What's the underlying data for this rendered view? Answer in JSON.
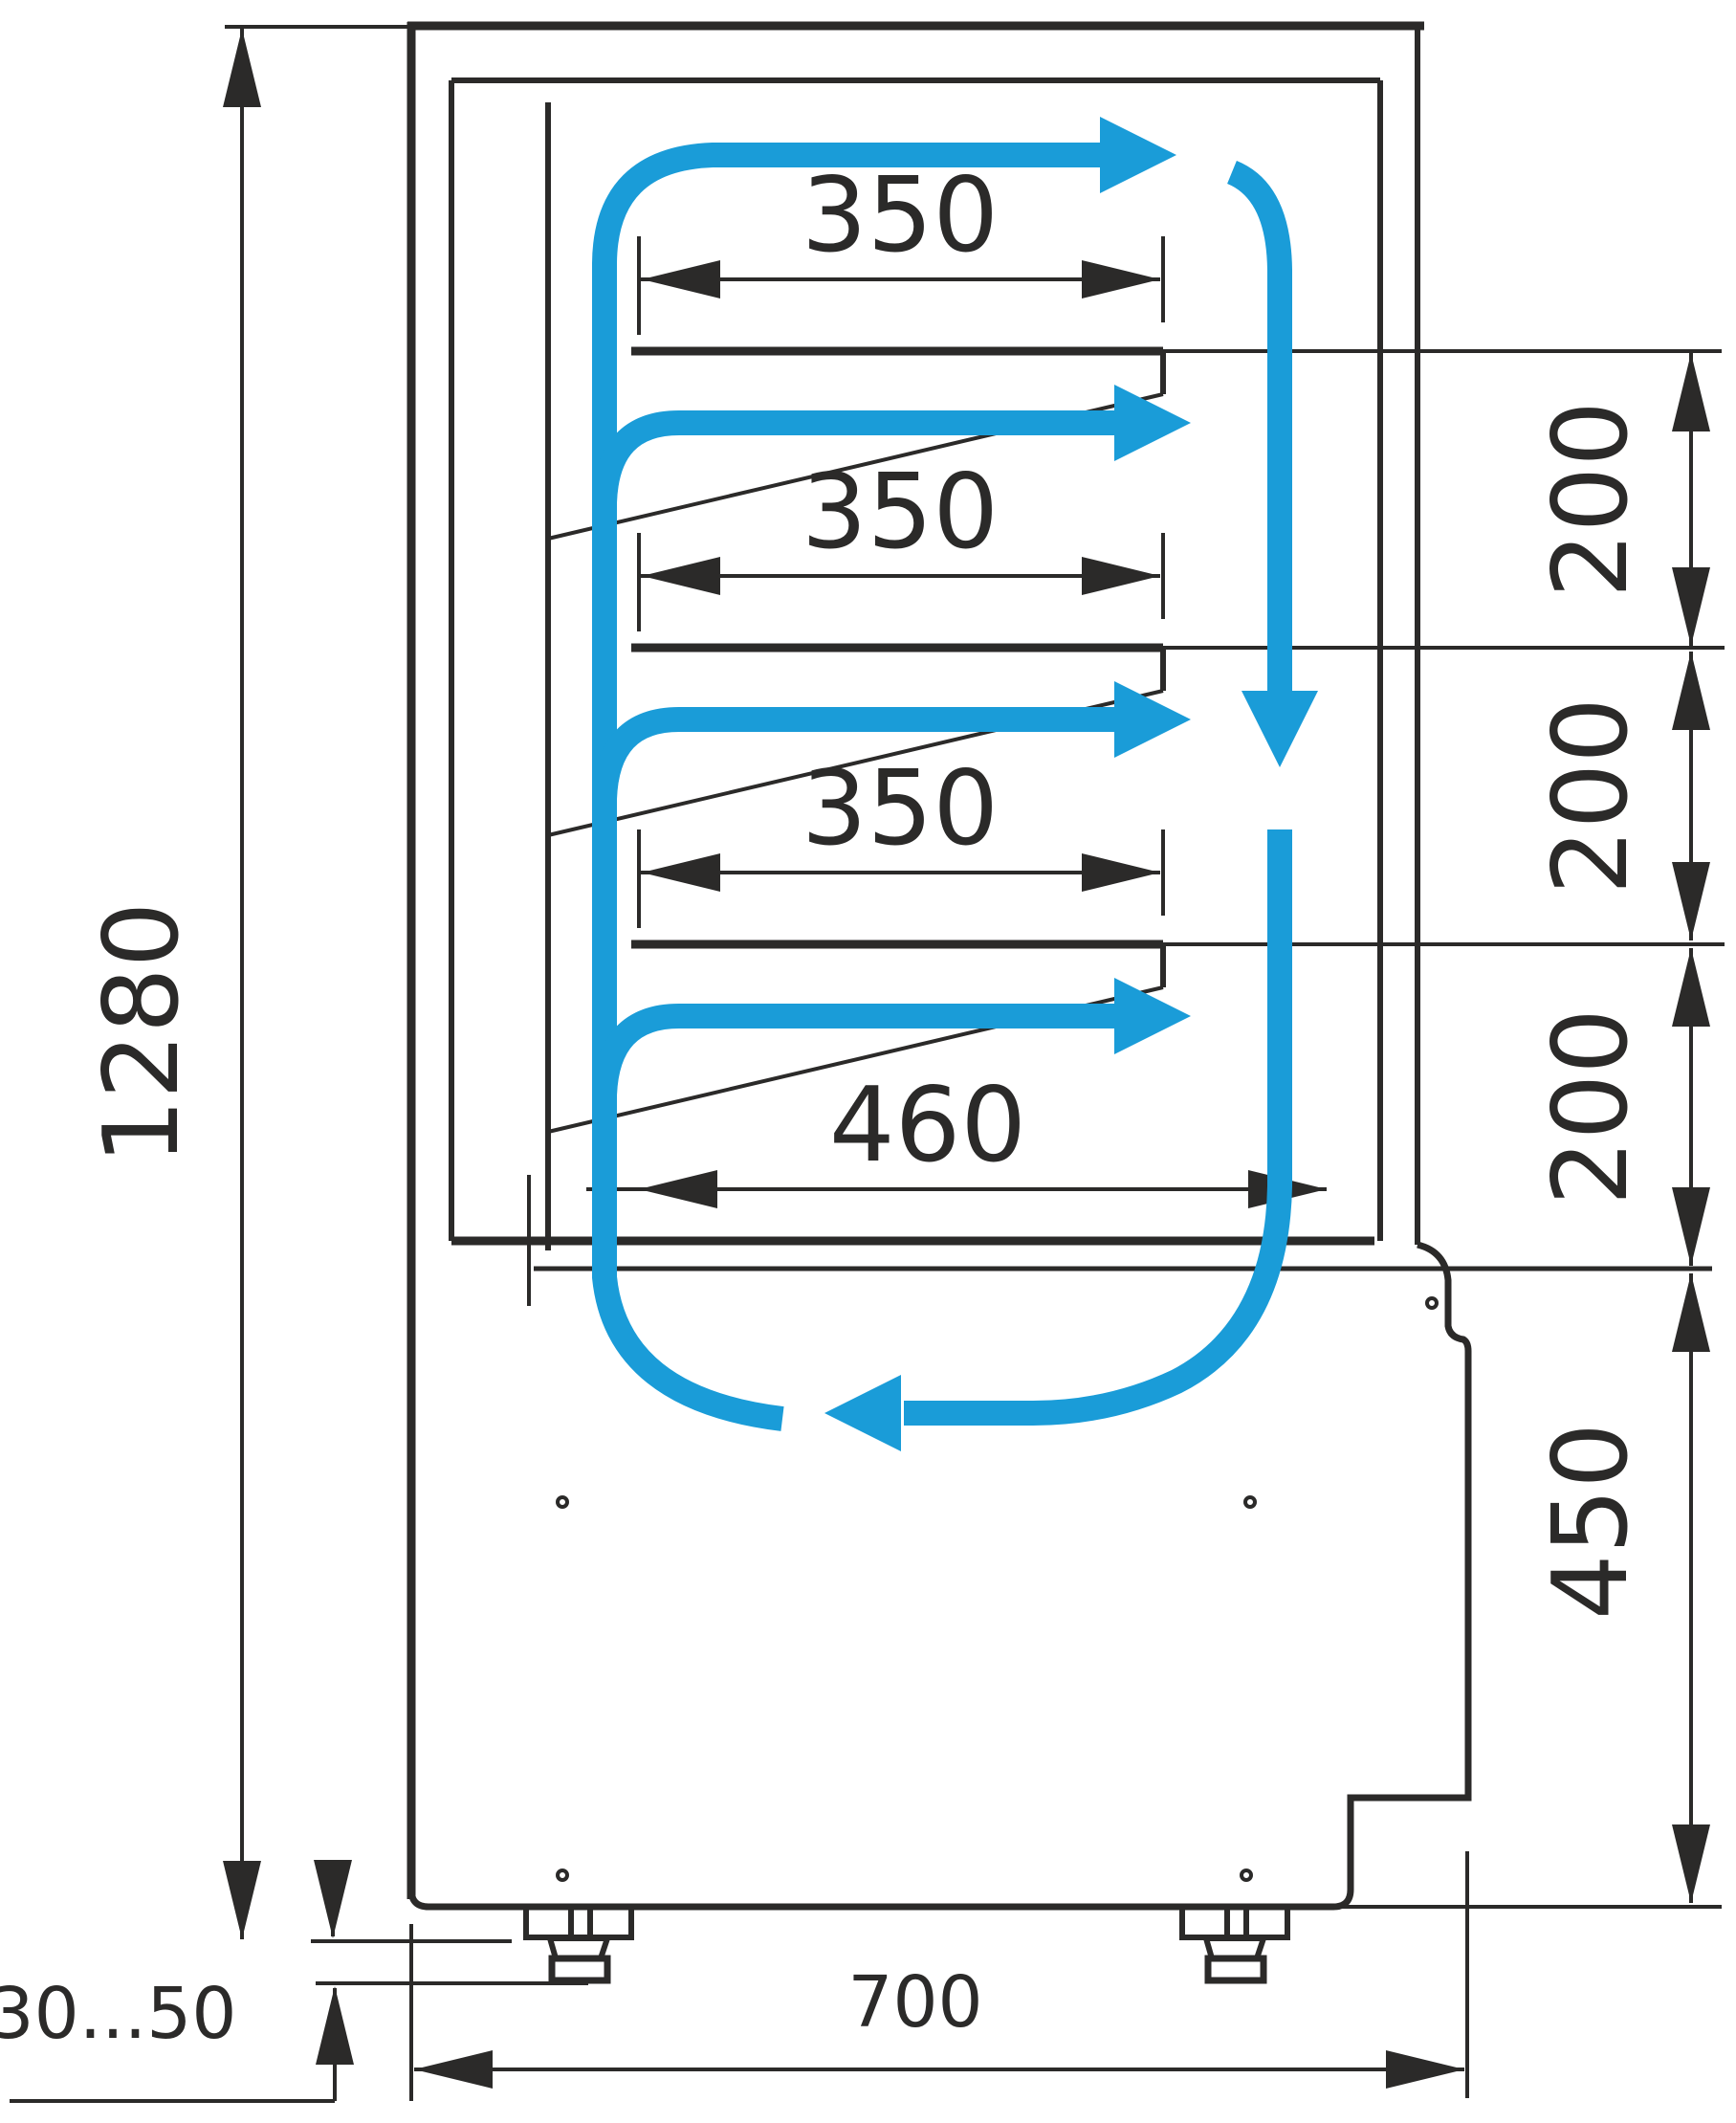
{
  "drawing": {
    "type": "technical-dimension-drawing",
    "subject": "refrigerated-display-case-side-section-with-air-circulation",
    "labels": {
      "overall_height": "1280",
      "shelf_width": "350",
      "shelf_gap": "200",
      "bottom_shelf_width": "460",
      "base_height": "450",
      "overall_depth": "700",
      "feet_range": "30...50"
    },
    "colors": {
      "line": "#2b2a29",
      "airflow": "#1a9cd8",
      "background": "#ffffff"
    }
  }
}
